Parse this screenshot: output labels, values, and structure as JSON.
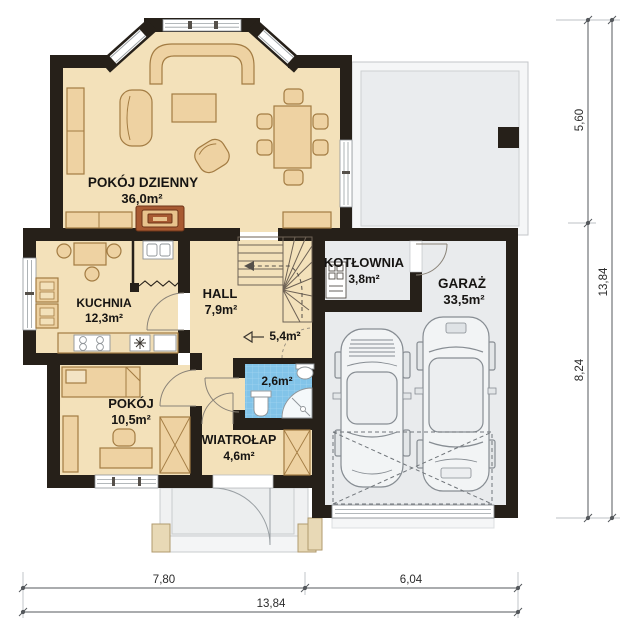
{
  "floorplan": {
    "title": "Parter - rzut kondygnacji",
    "rooms": {
      "living": {
        "name": "POKÓJ DZIENNY",
        "area": "36,0m²"
      },
      "kitchen": {
        "name": "KUCHNIA",
        "area": "12,3m²"
      },
      "hall": {
        "name": "HALL",
        "area": "7,9m²"
      },
      "understairs": {
        "area": "5,4m²"
      },
      "bathroom": {
        "area": "2,6m²"
      },
      "boiler": {
        "name": "KOTŁOWNIA",
        "area": "3,8m²"
      },
      "garage": {
        "name": "GARAŻ",
        "area": "33,5m²"
      },
      "bedroom": {
        "name": "POKÓJ",
        "area": "10,5m²"
      },
      "vestibule": {
        "name": "WIATROŁAP",
        "area": "4,6m²"
      }
    },
    "dimensions": {
      "right_upper": "5,60",
      "right_lower": "8,24",
      "right_total": "13,84",
      "bottom_left": "7,80",
      "bottom_right": "6,04",
      "bottom_total": "13,84"
    },
    "colors": {
      "wall": "#262019",
      "floor": "#f3e1ba",
      "furniture": "#eed2a2",
      "garage_floor": "#e9ebed",
      "bath_tile": "#82c4e9",
      "fireplace": "#a85a32"
    }
  }
}
